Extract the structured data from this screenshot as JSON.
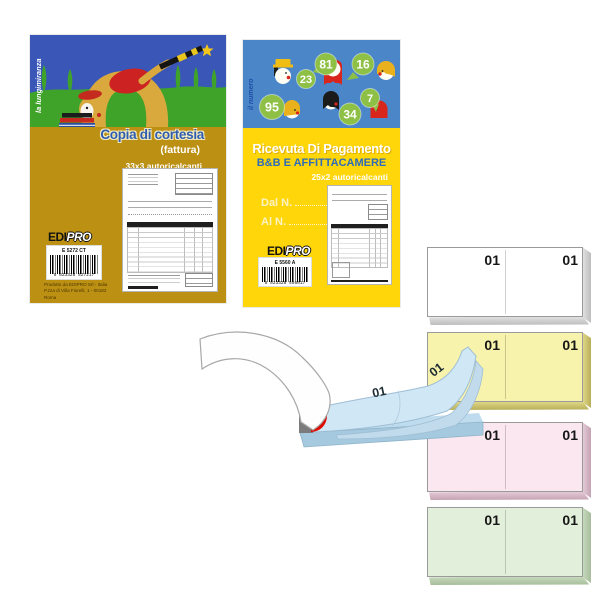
{
  "booklet1": {
    "vertical_label": "la lungimiranza",
    "title": "Copia di cortesia",
    "subtitle": "(fattura)",
    "spec": "33x3 autoricalcanti",
    "logo_edi": "EDI",
    "logo_pro": "PRO",
    "barcode_code": "E 5272 CT",
    "barcode_digits": "8 023328 527217",
    "footer_line1": "Prodotto da EDIPRO Srl - Italia",
    "footer_line2": "P.zza di Villa Fiorelli, 1 - 00182 Roma"
  },
  "booklet2": {
    "vertical_label": "il numero",
    "title": "Ricevuta Di Pagamento",
    "subtitle": "B&B E AFFITTACAMERE",
    "spec": "25x2 autoricalcanti",
    "dal_label": "Dal N.",
    "al_label": "Al N.",
    "bubbles": [
      "23",
      "81",
      "16",
      "95",
      "34",
      "7"
    ],
    "logo_edi": "EDI",
    "logo_pro": "PRO",
    "barcode_code": "E 5560 A",
    "barcode_digits": "8 023328 556017"
  },
  "pad": {
    "numbers": {
      "top": "01",
      "curl": "01",
      "under": "2"
    }
  },
  "blocks": [
    {
      "name": "white",
      "left_number": "01",
      "right_number": "01",
      "fill": "#FFFFFF"
    },
    {
      "name": "yellow",
      "left_number": "01",
      "right_number": "01",
      "fill": "#F7F3AC"
    },
    {
      "name": "pink",
      "left_number": "01",
      "right_number": "01",
      "fill": "#FAE7EF"
    },
    {
      "name": "green",
      "left_number": "01",
      "right_number": "01",
      "fill": "#E2EFDA"
    }
  ],
  "colors": {
    "booklet1_gold": "#BC9012",
    "booklet1_title_blue": "#2E5DB0",
    "booklet1_sky": "#3A57B7",
    "booklet1_green": "#3FA32A",
    "booklet2_yellow": "#FFD60A",
    "booklet2_sky": "#4B86C9",
    "booklet2_subtitle_blue": "#2E6CB8",
    "bubble_green": "#8DC045",
    "pad_sheet_blue": "#D0E7F6",
    "pad_base_blue": "#A5C9DF",
    "binding_grey": "#7B7B7B",
    "binding_red": "#DE0B00"
  }
}
